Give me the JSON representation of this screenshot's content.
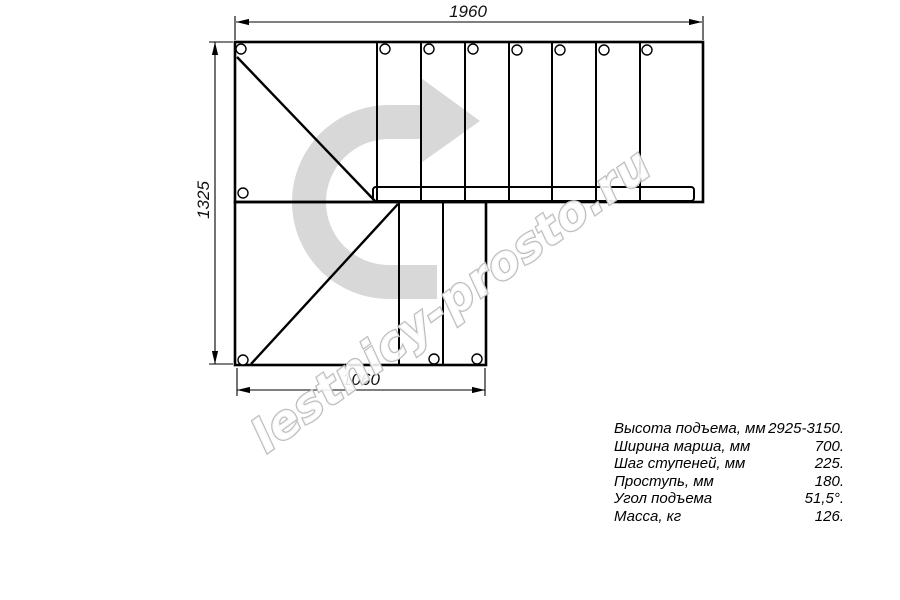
{
  "watermark": {
    "text": "lestnicy-prosto.ru",
    "arrow_icon": "u-turn-right-arrow"
  },
  "dimensions": {
    "top": "1960",
    "left": "1325",
    "bottom": "1060"
  },
  "specs": {
    "rows": [
      {
        "label": "Высота подъема, мм",
        "value": "2925-3150."
      },
      {
        "label": "Ширина марша, мм",
        "value": "700."
      },
      {
        "label": "Шаг ступеней, мм",
        "value": "225."
      },
      {
        "label": "Проступь, мм",
        "value": "180."
      },
      {
        "label": "Угол подъема",
        "value": "51,5°."
      },
      {
        "label": "Масса, кг",
        "value": "126."
      }
    ]
  },
  "colors": {
    "background": "#ffffff",
    "line": "#000000",
    "watermark_arrow": "#d8d8d8",
    "watermark_text_fill": "#ffffff",
    "watermark_text_stroke": "#bdbdbd"
  }
}
